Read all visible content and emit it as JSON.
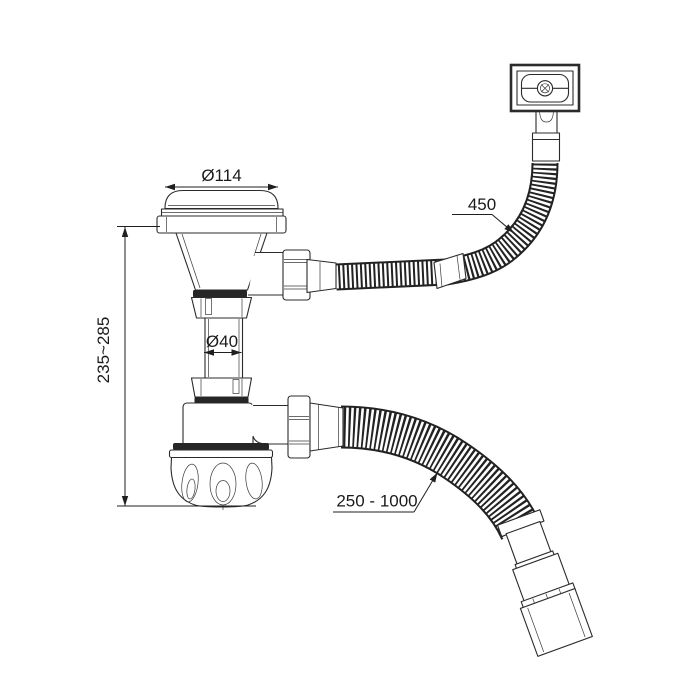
{
  "drawing": {
    "labels": {
      "cap_diameter": "Ø114",
      "pipe_diameter": "Ø40",
      "height_range": "235~285",
      "overflow_hose_length": "450",
      "outlet_hose_length": "250 - 1000"
    },
    "colors": {
      "line": "#2b2b2b",
      "background": "#ffffff",
      "accent_dark": "#262626"
    }
  }
}
